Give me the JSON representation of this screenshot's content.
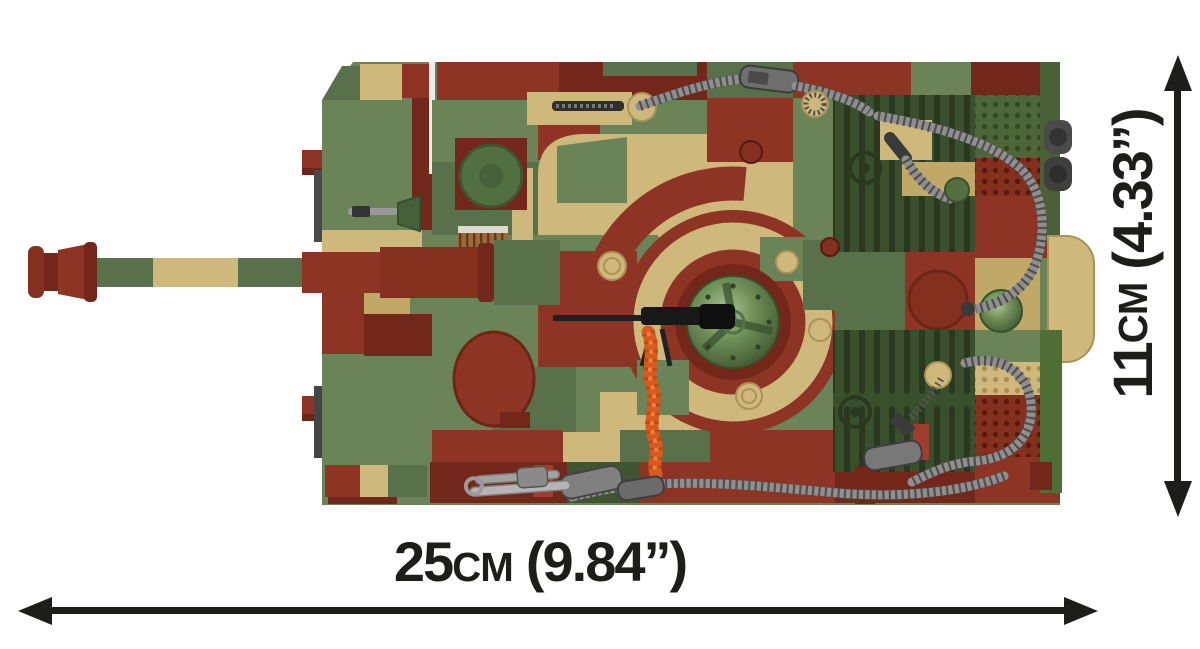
{
  "image": {
    "alt": "Top-down view of a COBI brick model tank in green, tan and brick-red camouflage with grey tow cables and an orange track chain"
  },
  "dimensions": {
    "width": {
      "value": "25",
      "unit": "cm",
      "imperial": "(9.84”)",
      "full": "25cm (9.84”)"
    },
    "height": {
      "value": "11",
      "unit": "cm",
      "imperial": "(4.33”)",
      "full": "11cm (4.33”)"
    }
  },
  "icons": {
    "width_arrow": "double-headed-arrow-horizontal",
    "height_arrow": "double-headed-arrow-vertical"
  },
  "colors": {
    "background": "#ffffff",
    "dimension_text": "#1d1d1b",
    "camo_green": "#6b8457",
    "camo_green_dark": "#59714a",
    "camo_tan": "#cfb87b",
    "camo_red": "#8e3425",
    "camo_red_dark": "#72271a",
    "engine_deck_green": "#3a4f2c",
    "cable_gray": "#8f8f8f",
    "track_chain_orange": "#d85a1e"
  }
}
